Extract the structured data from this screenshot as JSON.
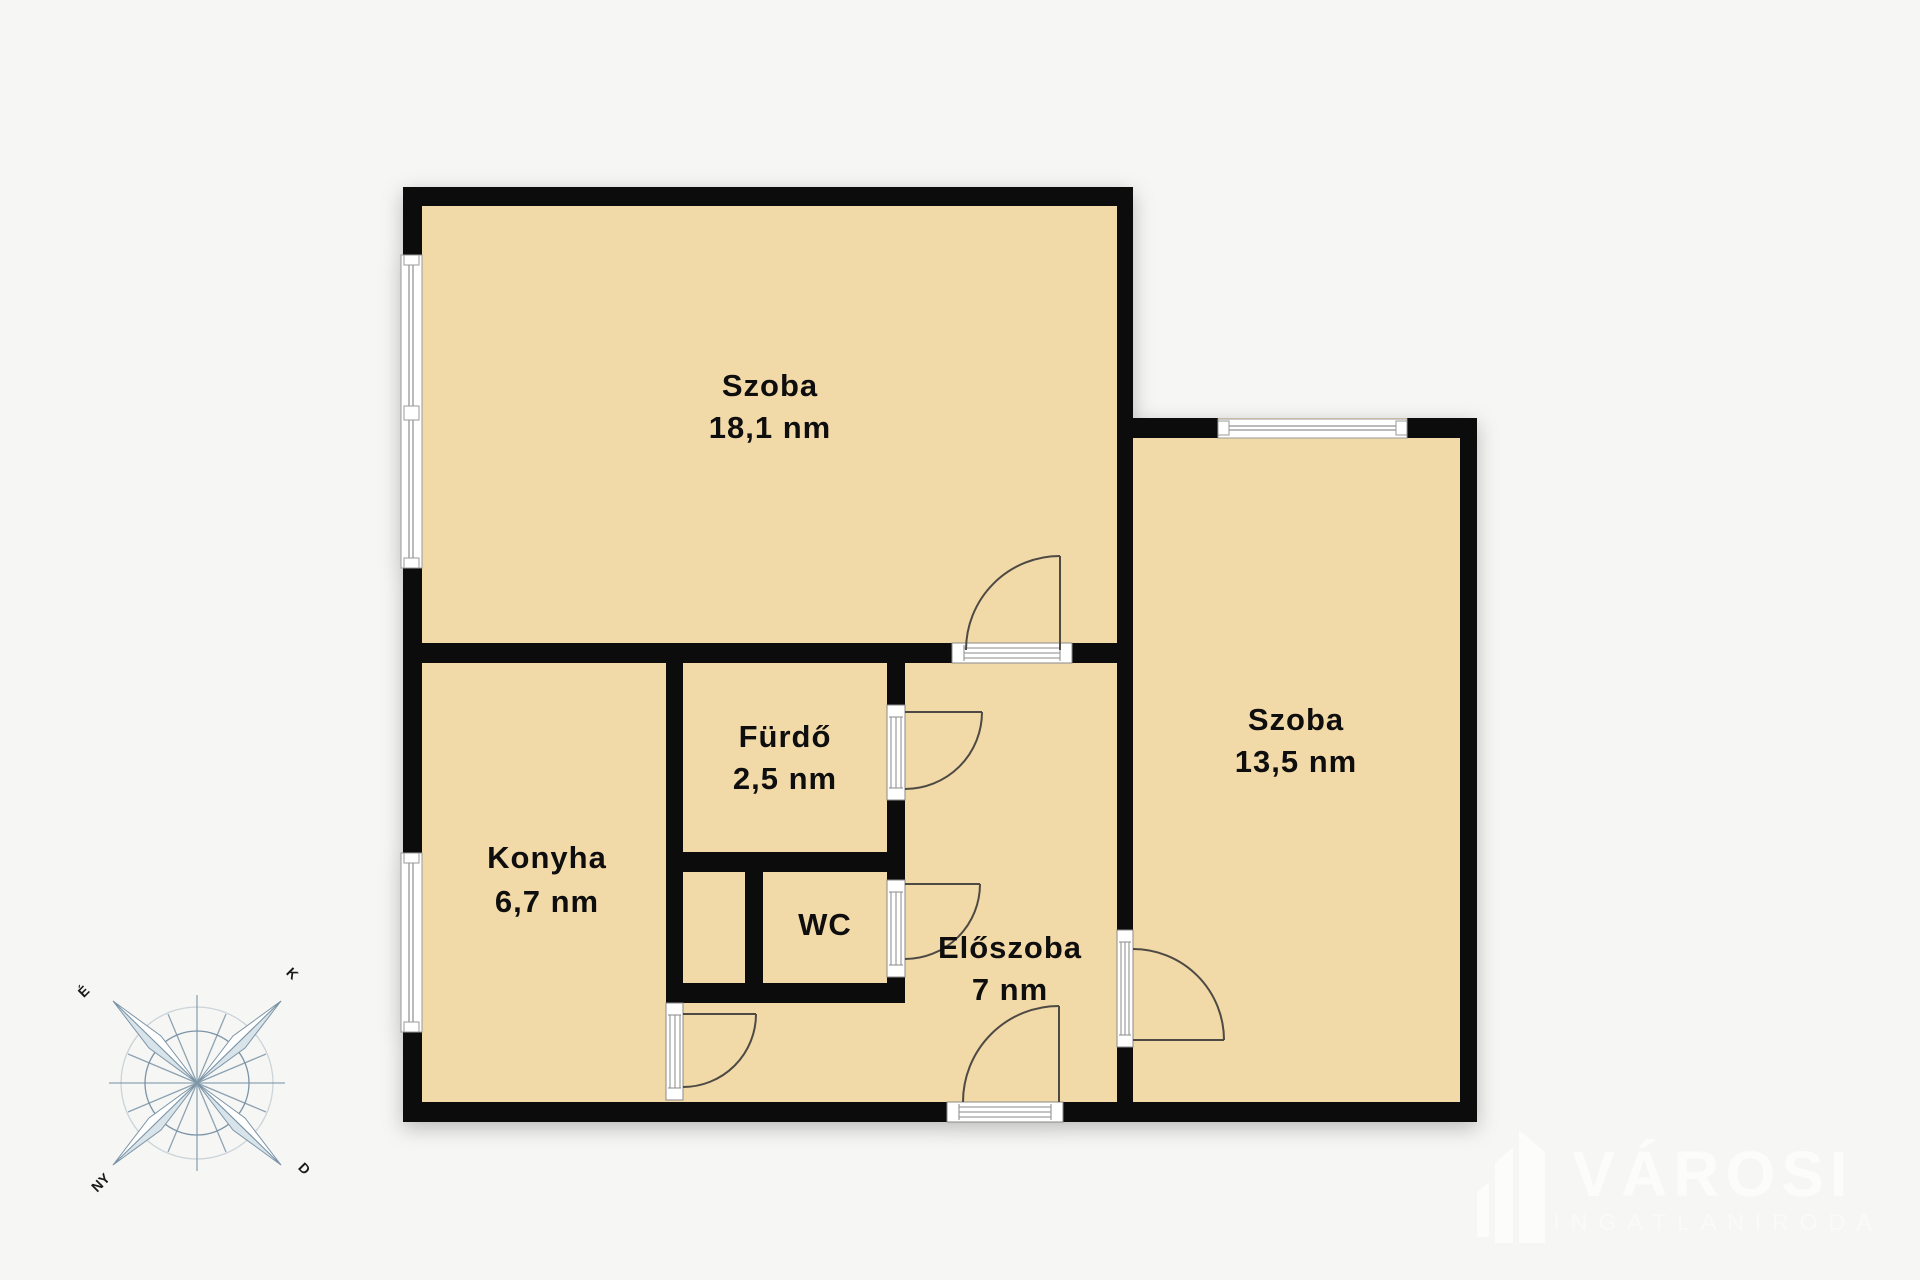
{
  "rooms": [
    {
      "id": "szoba1",
      "name": "Szoba",
      "area": "18,1 nm"
    },
    {
      "id": "konyha",
      "name": "Konyha",
      "area": "6,7 nm"
    },
    {
      "id": "furdo",
      "name": "Fürdő",
      "area": "2,5 nm"
    },
    {
      "id": "wc",
      "name": "WC",
      "area": ""
    },
    {
      "id": "eloszoba",
      "name": "Előszoba",
      "area": "7 nm"
    },
    {
      "id": "szoba2",
      "name": "Szoba",
      "area": "13,5 nm"
    }
  ],
  "compass": {
    "north": "É",
    "east": "K",
    "south": "D",
    "west": "NY"
  },
  "logo": {
    "brand": "VÁROSI",
    "subtitle": "INGATLANIRODA"
  },
  "colors": {
    "background": "#f6f6f5",
    "floor": "#f2d9a8",
    "wall": "#0c0c0c",
    "door_line": "#4d4a44",
    "compass_line": "#7b94a6",
    "logo": "#fcfcfa",
    "label_text": "#0e0e0e"
  }
}
